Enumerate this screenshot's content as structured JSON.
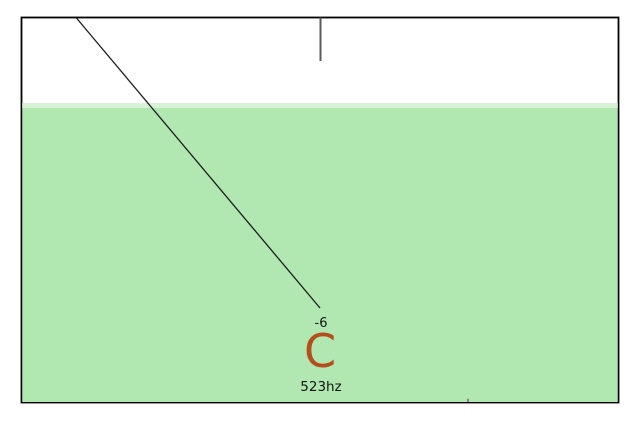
{
  "tuner": {
    "cents_offset": "-6",
    "note": "C",
    "frequency": "523hz"
  },
  "colors": {
    "meter_fill": "#b1e7b1",
    "meter_fill_light": "#d8f2d8",
    "frame_border": "#000000",
    "needle": "#1c1c1c",
    "center_tick": "#5a5a5a",
    "minor_tick": "#8a8a8a",
    "note_color": "#b44e1c",
    "text_color": "#141414"
  }
}
